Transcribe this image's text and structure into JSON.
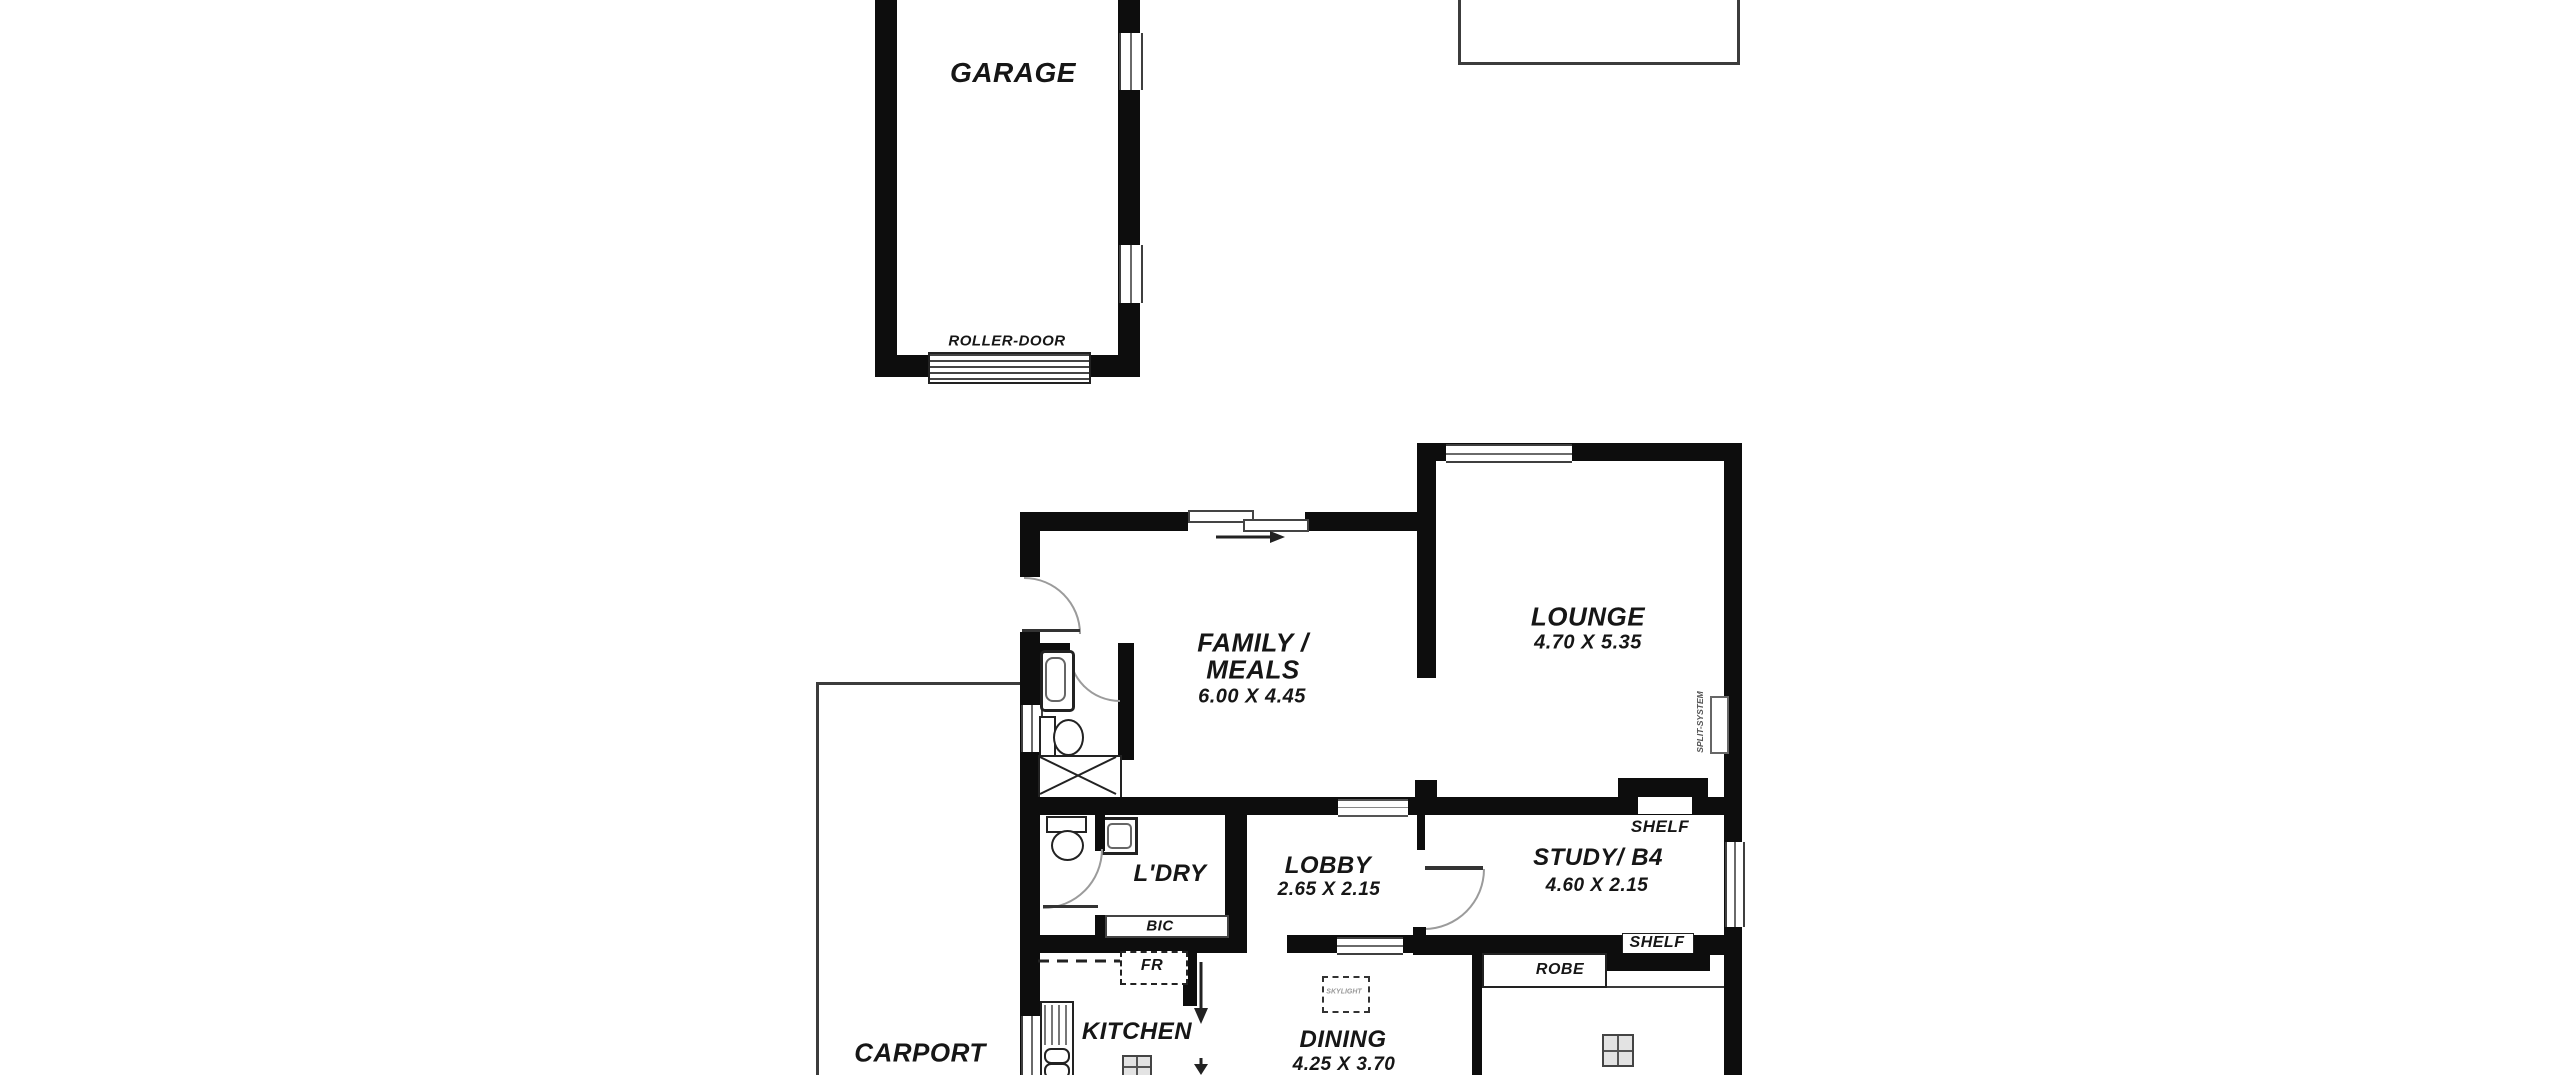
{
  "plan_type": "residential floor plan",
  "colors": {
    "wall": "#0d0d0d",
    "thin_line": "#3c3c3c",
    "door_arc": "#9b9b9b",
    "background": "#ffffff",
    "text": "#161616"
  },
  "rooms": {
    "garage": {
      "name": "GARAGE"
    },
    "family_meals": {
      "name_line1": "FAMILY /",
      "name_line2": "MEALS",
      "dims": "6.00 X 4.45"
    },
    "lounge": {
      "name": "LOUNGE",
      "dims": "4.70 X 5.35"
    },
    "laundry": {
      "name": "L'DRY"
    },
    "lobby": {
      "name": "LOBBY",
      "dims": "2.65 X 2.15"
    },
    "study": {
      "name": "STUDY/ B4",
      "dims": "4.60 X 2.15"
    },
    "kitchen": {
      "name": "KITCHEN"
    },
    "dining": {
      "name": "DINING",
      "dims": "4.25 X 3.70"
    },
    "carport": {
      "name": "CARPORT"
    }
  },
  "features": {
    "roller_door": "ROLLER-DOOR",
    "shelf_top": "SHELF",
    "shelf_bottom": "SHELF",
    "robe": "ROBE",
    "built_in_cupboard": "BIC",
    "fridge": "FR",
    "skylight": "SKYLIGHT",
    "split_system": "SPLIT-SYSTEM"
  }
}
